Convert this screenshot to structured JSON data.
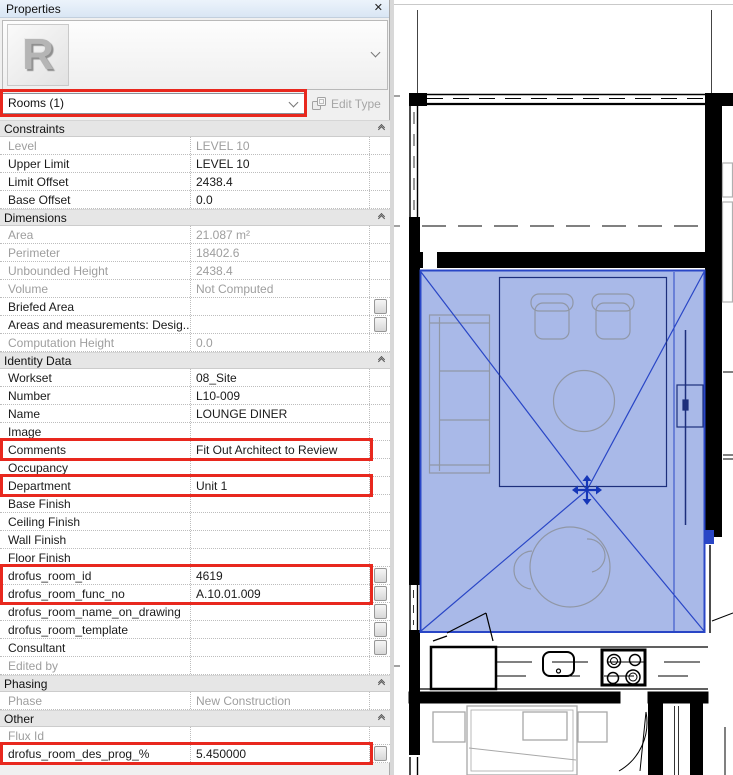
{
  "colors": {
    "highlight_red": "#e8281e",
    "selection_stroke": "#2946c6",
    "selection_fill": "#a9b9e8",
    "furniture_gray": "#9097a6"
  },
  "properties_panel": {
    "title": "Properties",
    "close_icon": "✕",
    "type_selector": {
      "value": "Rooms (1)"
    },
    "edit_type_label": "Edit Type",
    "sections": [
      {
        "name": "Constraints",
        "rows": [
          {
            "label": "Level",
            "value": "LEVEL 10",
            "disabled": true
          },
          {
            "label": "Upper Limit",
            "value": "LEVEL 10"
          },
          {
            "label": "Limit Offset",
            "value": "2438.4"
          },
          {
            "label": "Base Offset",
            "value": "0.0"
          }
        ]
      },
      {
        "name": "Dimensions",
        "rows": [
          {
            "label": "Area",
            "value": "21.087 m²",
            "disabled": true
          },
          {
            "label": "Perimeter",
            "value": "18402.6",
            "disabled": true
          },
          {
            "label": "Unbounded Height",
            "value": "2438.4",
            "disabled": true
          },
          {
            "label": "Volume",
            "value": "Not Computed",
            "disabled": true
          },
          {
            "label": "Briefed Area",
            "value": "",
            "button": true
          },
          {
            "label": "Areas and measurements: Desig...",
            "value": "",
            "button": true
          },
          {
            "label": "Computation Height",
            "value": "0.0",
            "disabled": true
          }
        ]
      },
      {
        "name": "Identity Data",
        "rows": [
          {
            "label": "Workset",
            "value": "08_Site"
          },
          {
            "label": "Number",
            "value": "L10-009"
          },
          {
            "label": "Name",
            "value": "LOUNGE DINER"
          },
          {
            "label": "Image",
            "value": ""
          },
          {
            "label": "Comments",
            "value": "Fit Out Architect to Review"
          },
          {
            "label": "Occupancy",
            "value": ""
          },
          {
            "label": "Department",
            "value": "Unit 1"
          },
          {
            "label": "Base Finish",
            "value": ""
          },
          {
            "label": "Ceiling Finish",
            "value": ""
          },
          {
            "label": "Wall Finish",
            "value": ""
          },
          {
            "label": "Floor Finish",
            "value": ""
          },
          {
            "label": "drofus_room_id",
            "value": "4619",
            "button": true
          },
          {
            "label": "drofus_room_func_no",
            "value": "A.10.01.009",
            "button": true
          },
          {
            "label": "drofus_room_name_on_drawing",
            "value": "",
            "button": true
          },
          {
            "label": "drofus_room_template",
            "value": "",
            "button": true
          },
          {
            "label": "Consultant",
            "value": "",
            "button": true
          },
          {
            "label": "Edited by",
            "value": "",
            "disabled": true
          }
        ]
      },
      {
        "name": "Phasing",
        "rows": [
          {
            "label": "Phase",
            "value": "New Construction",
            "disabled": true
          }
        ]
      },
      {
        "name": "Other",
        "rows": [
          {
            "label": "Flux Id",
            "value": "",
            "disabled": true
          },
          {
            "label": "drofus_room_des_prog_%",
            "value": "5.450000",
            "button": true
          }
        ]
      }
    ]
  }
}
